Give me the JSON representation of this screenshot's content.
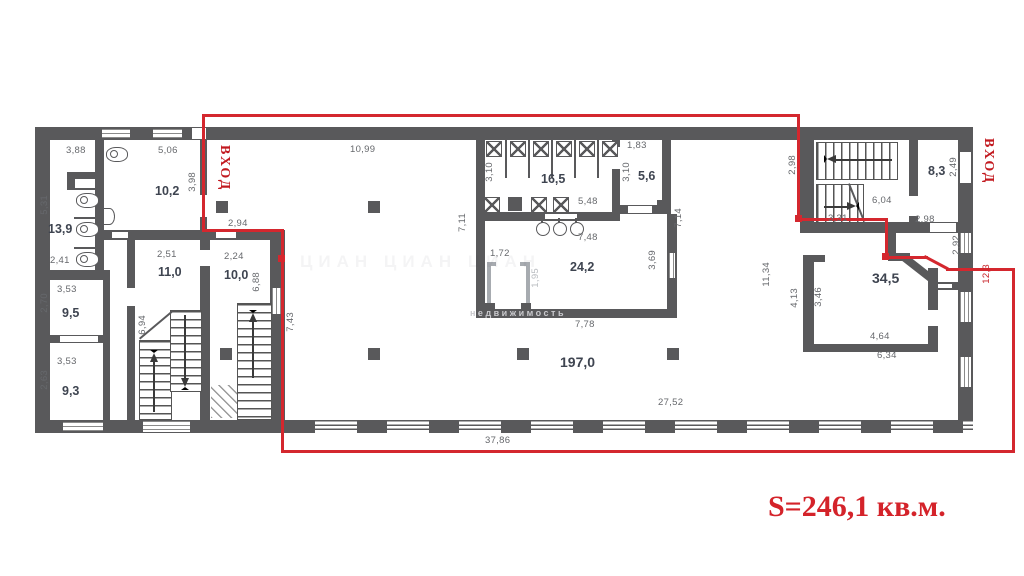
{
  "labels": {
    "total_area": "S=246,1 кв.м.",
    "entrance_left": "ВХОД",
    "entrance_right": "ВХОД",
    "watermark_row": "ЦИАН   ЦИАН   ЦИАН",
    "watermark_wall": "недвижимость"
  },
  "rooms": {
    "r139": "13,9",
    "r102": "10,2",
    "r95": "9,5",
    "r110": "11,0",
    "r100": "10,0",
    "r93": "9,3",
    "r165": "16,5",
    "r56": "5,6",
    "r242": "24,2",
    "r1970": "197,0",
    "r83": "8,3",
    "r345": "34,5"
  },
  "dims": {
    "d388": "3,88",
    "d506": "5,06",
    "d531": "5,31",
    "d241": "2,41",
    "d398": "3,98",
    "d294": "2,94",
    "d1099": "10,99",
    "d251": "2,51",
    "d224": "2,24",
    "d688": "6,88",
    "d694": "6,94",
    "d353a": "3,53",
    "d270": "2,70",
    "d353b": "3,53",
    "d263": "2,63",
    "d743": "7,43",
    "d711": "7,11",
    "d310a": "3,10",
    "d548": "5,48",
    "d183": "1,83",
    "d310b": "3,10",
    "d748": "7,48",
    "d714": "7,14",
    "d172": "1,72",
    "d195": "1,95",
    "d369": "3,69",
    "d778": "7,78",
    "d1134": "11,34",
    "d298a": "2,98",
    "d604": "6,04",
    "d249": "2,49",
    "d331": "3,31",
    "d298b": "2,98",
    "d292": "2,92",
    "d123": "12,3",
    "d413": "4,13",
    "d346": "3,46",
    "d464": "4,64",
    "d634": "6,34",
    "d2752": "27,52",
    "d3786": "37,86"
  }
}
